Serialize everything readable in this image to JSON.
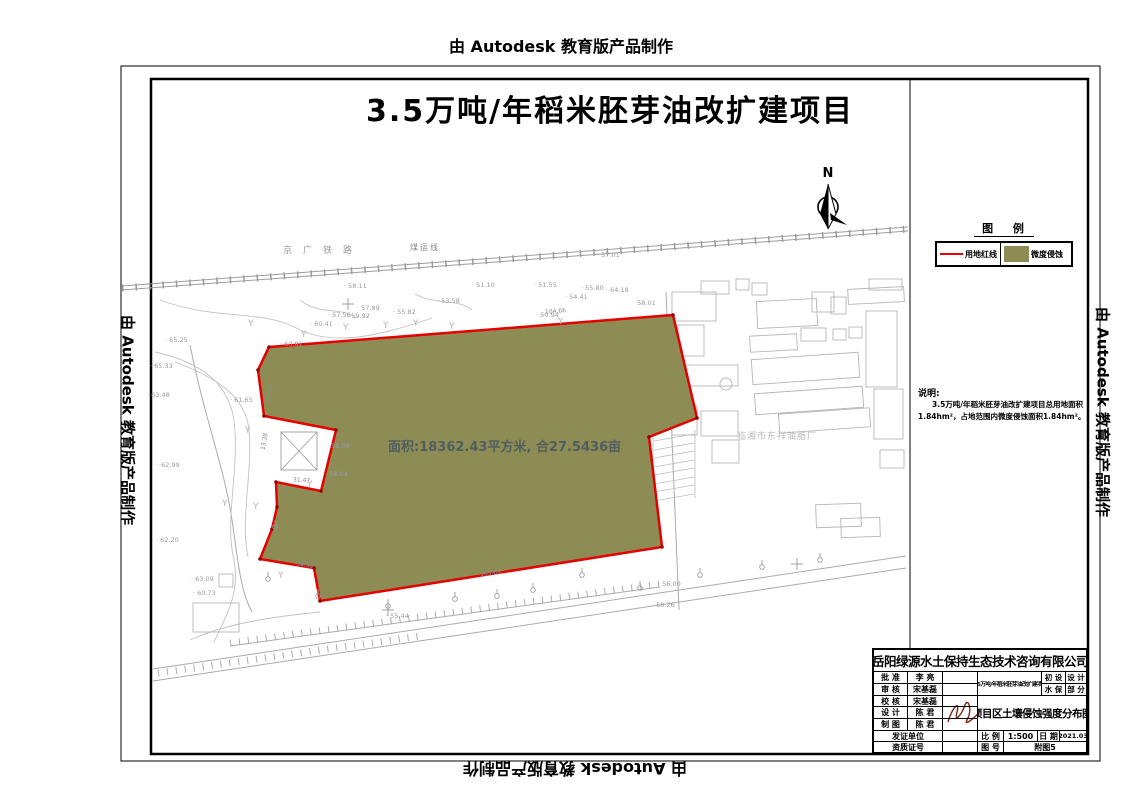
{
  "watermark": {
    "text": "由 Autodesk 教育版产品制作"
  },
  "sheet": {
    "title": "3.5万吨/年稻米胚芽油改扩建项目"
  },
  "legend": {
    "title": "图 例",
    "items": [
      {
        "symbol": "red-line",
        "label": "用地红线",
        "color": "#e60000"
      },
      {
        "symbol": "olive-swatch",
        "label": "微度侵蚀",
        "color": "#8e8c55"
      }
    ]
  },
  "notes": {
    "heading": "说明:",
    "line1": "3.5万吨/年稻米胚芽油改扩建项目总用地面积",
    "line2": "1.84hm²，占地范围内微度侵蚀面积1.84hm²。"
  },
  "map": {
    "north_label": "N",
    "area_label": "面积:18362.43平方米, 合27.5436亩",
    "factory_label": "临湘市东祥油脂厂",
    "railway_label": "京广铁路",
    "railway_label2": "煤运线",
    "tree_symbol": "Y",
    "boundary_color": "#e60000",
    "erosion_fill": "#8e8c55",
    "spot_elevations": [
      {
        "v": "57.01",
        "x": 597,
        "y": 251
      },
      {
        "v": "58.11",
        "x": 344,
        "y": 282
      },
      {
        "v": "60.81",
        "x": 280,
        "y": 340
      },
      {
        "v": "60.41",
        "x": 310,
        "y": 320
      },
      {
        "v": "57.56",
        "x": 328,
        "y": 311
      },
      {
        "v": "59.92",
        "x": 347,
        "y": 312
      },
      {
        "v": "57.89",
        "x": 357,
        "y": 304
      },
      {
        "v": "55.82",
        "x": 393,
        "y": 308
      },
      {
        "v": "53.58",
        "x": 437,
        "y": 297
      },
      {
        "v": "51.10",
        "x": 472,
        "y": 281
      },
      {
        "v": "51.55",
        "x": 534,
        "y": 281
      },
      {
        "v": "50.94",
        "x": 536,
        "y": 311
      },
      {
        "v": "54.41",
        "x": 565,
        "y": 293
      },
      {
        "v": "55.80",
        "x": 581,
        "y": 284
      },
      {
        "v": "64.18",
        "x": 606,
        "y": 286
      },
      {
        "v": "58.01",
        "x": 633,
        "y": 299
      },
      {
        "v": "65.25",
        "x": 165,
        "y": 336
      },
      {
        "v": "65.33",
        "x": 150,
        "y": 362
      },
      {
        "v": "63.48",
        "x": 147,
        "y": 391
      },
      {
        "v": "61.65",
        "x": 230,
        "y": 396
      },
      {
        "v": "62.99",
        "x": 157,
        "y": 461
      },
      {
        "v": "62.20",
        "x": 156,
        "y": 536
      },
      {
        "v": "63.09",
        "x": 191,
        "y": 575
      },
      {
        "v": "60.73",
        "x": 193,
        "y": 589
      },
      {
        "v": "55.44",
        "x": 386,
        "y": 612
      },
      {
        "v": "56.00",
        "x": 658,
        "y": 580
      },
      {
        "v": "58.26",
        "x": 652,
        "y": 601
      },
      {
        "v": "58.08",
        "x": 327,
        "y": 442
      },
      {
        "v": "58.04",
        "x": 325,
        "y": 470
      }
    ],
    "dim_labels": [
      {
        "v": "104.66",
        "x": 545,
        "y": 308,
        "r": -5
      },
      {
        "v": "103.69",
        "x": 480,
        "y": 570,
        "r": -8
      },
      {
        "v": "34.30",
        "x": 296,
        "y": 562,
        "r": 8
      },
      {
        "v": "31.47",
        "x": 293,
        "y": 477,
        "r": 3
      },
      {
        "v": "13.38",
        "x": 256,
        "y": 438,
        "r": -80
      },
      {
        "v": "15.36",
        "x": 261,
        "y": 390,
        "r": -75
      }
    ]
  },
  "titleblock": {
    "company": "岳阳绿源水土保持生态技术咨询有限公司",
    "rows": [
      {
        "label": "批 准",
        "value": "李 亮"
      },
      {
        "label": "审 核",
        "value": "宋基磊"
      },
      {
        "label": "校 核",
        "value": "宋基磊"
      },
      {
        "label": "设 计",
        "value": "陈 君"
      },
      {
        "label": "制 图",
        "value": "陈 君"
      }
    ],
    "project": "3.5万吨/年稻米胚芽油改扩建项目",
    "stage": {
      "c1": "初 设",
      "c2": "设 计",
      "c3": "水 保",
      "c4": "部 分"
    },
    "drawing_title": "项目区土壤侵蚀强度分布图",
    "cert_unit": "发证单位",
    "cert_no": "资质证号",
    "scale_label": "比 例",
    "scale_value": "1:500",
    "date_label": "日 期",
    "date_value": "2021.03",
    "fig_label": "图 号",
    "fig_value": "附图5"
  }
}
